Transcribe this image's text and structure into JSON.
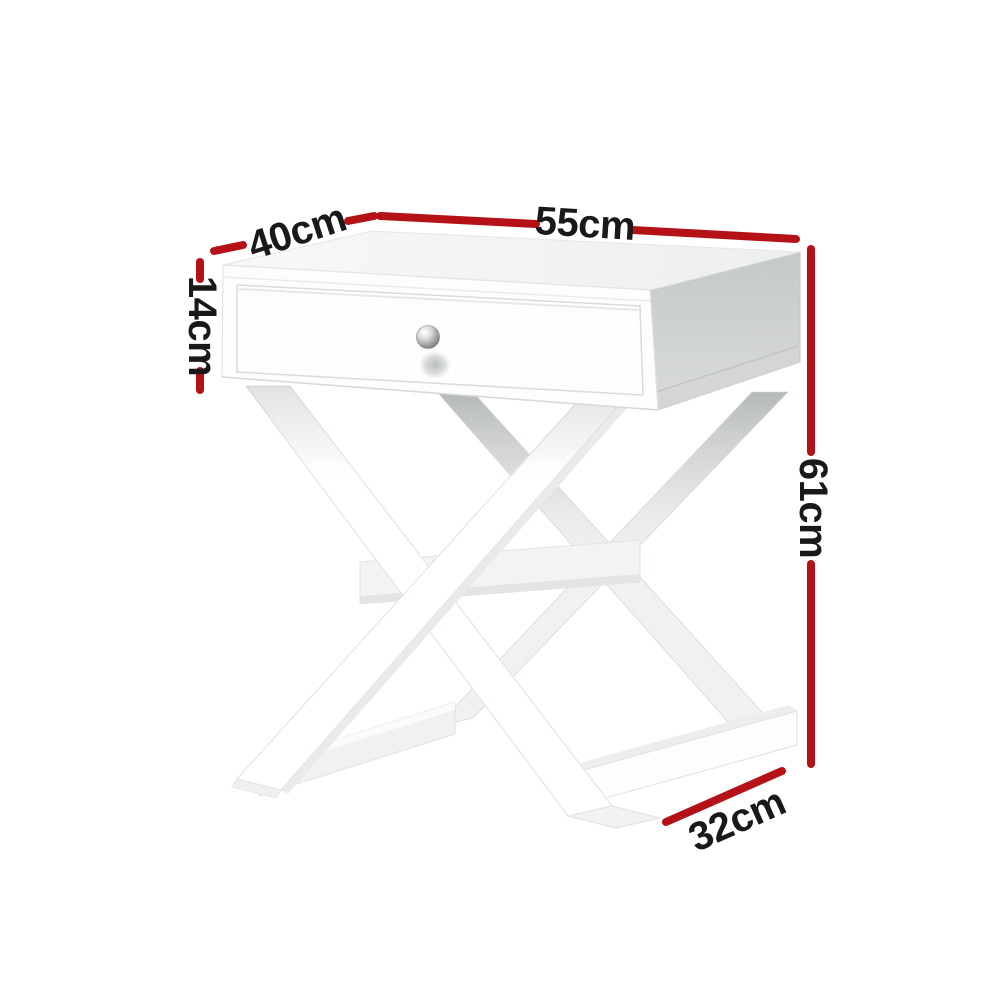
{
  "diagram": {
    "labels": {
      "top_width": "55cm",
      "top_depth": "40cm",
      "drawer_height": "14cm",
      "overall_height": "61cm",
      "base_depth": "32cm"
    },
    "colors": {
      "dimension_line": "#b51217",
      "label_text": "#191919",
      "background": "#ffffff",
      "table_body": "#ffffff",
      "table_side_shade": "#cdd0d0",
      "knob_metal": "#9fa2a3"
    }
  }
}
